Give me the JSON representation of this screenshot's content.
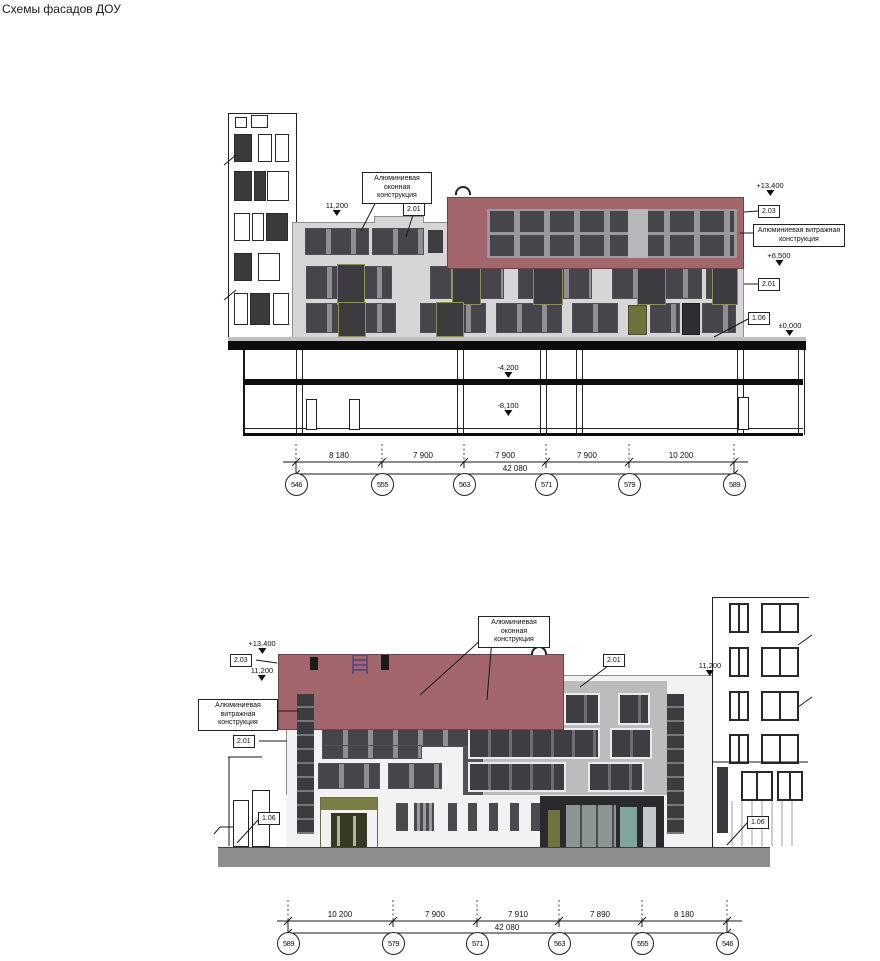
{
  "page": {
    "title": "Схемы фасадов ДОУ"
  },
  "shared": {
    "window_label": "Алюминиевая оконная конструкция",
    "curtain_label": "Алюминиевая витражная конструкция",
    "total_dim": "42 080"
  },
  "facade_top": {
    "elev_top": "+13,400",
    "elev_parapet": "11,200",
    "elev_red_bottom": "+6,500",
    "elev_zero": "±0,000",
    "elev_base1": "-4,200",
    "elev_base2": "-8,100",
    "tag_window": "2.01",
    "tag_red": "2.03",
    "tag_wall": "2.01",
    "tag_base": "1.06",
    "dims": [
      "8 180",
      "7 900",
      "7 900",
      "7 900",
      "10 200"
    ],
    "axes": [
      "546",
      "555",
      "563",
      "571",
      "579",
      "589"
    ]
  },
  "facade_bottom": {
    "elev_top": "+13,400",
    "elev_parapet_left": "11,200",
    "elev_parapet_right": "11,200",
    "tag_red": "2.03",
    "tag_wall_left": "2.01",
    "tag_wall_right": "2.01",
    "tag_base_left": "1.06",
    "tag_base_right": "1.06",
    "dims": [
      "10 200",
      "7 900",
      "7 910",
      "7 890",
      "8 180"
    ],
    "axes": [
      "589",
      "579",
      "571",
      "563",
      "555",
      "546"
    ]
  }
}
